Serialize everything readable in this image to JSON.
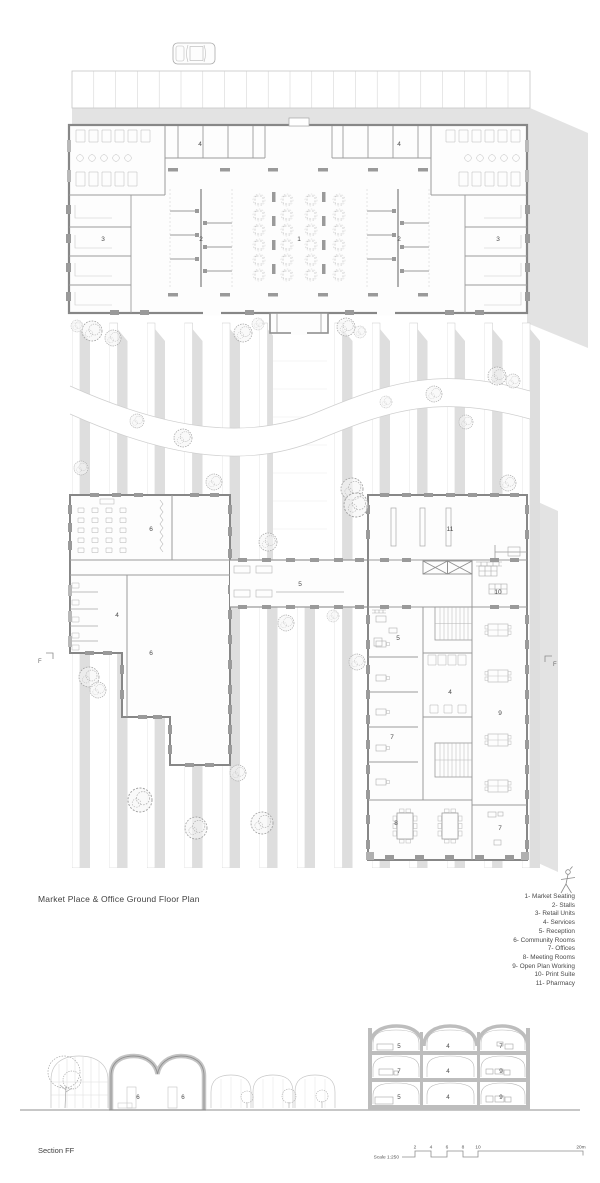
{
  "plan": {
    "title": "Market Place & Office Ground Floor Plan",
    "section_marker_left": "F",
    "section_marker_right": "F",
    "room_labels": [
      {
        "text": "4",
        "x": 200,
        "y": 146
      },
      {
        "text": "4",
        "x": 399,
        "y": 146
      },
      {
        "text": "3",
        "x": 103,
        "y": 241
      },
      {
        "text": "2",
        "x": 201,
        "y": 241
      },
      {
        "text": "1",
        "x": 299,
        "y": 241
      },
      {
        "text": "2",
        "x": 399,
        "y": 241
      },
      {
        "text": "3",
        "x": 498,
        "y": 241
      },
      {
        "text": "6",
        "x": 151,
        "y": 531
      },
      {
        "text": "11",
        "x": 450,
        "y": 531
      },
      {
        "text": "5",
        "x": 300,
        "y": 586
      },
      {
        "text": "10",
        "x": 498,
        "y": 594
      },
      {
        "text": "4",
        "x": 117,
        "y": 617
      },
      {
        "text": "5",
        "x": 398,
        "y": 640
      },
      {
        "text": "6",
        "x": 151,
        "y": 655
      },
      {
        "text": "4",
        "x": 450,
        "y": 694
      },
      {
        "text": "9",
        "x": 500,
        "y": 715
      },
      {
        "text": "7",
        "x": 392,
        "y": 739
      },
      {
        "text": "8",
        "x": 396,
        "y": 825
      },
      {
        "text": "7",
        "x": 500,
        "y": 830
      }
    ]
  },
  "legend": {
    "items": [
      "1- Market Seating",
      "2- Stalls",
      "3- Retail Units",
      "4- Services",
      "5- Reception",
      "6- Community Rooms",
      "7- Offices",
      "8- Meeting Rooms",
      "9- Open Plan Working",
      "10- Print Suite",
      "11- Pharmacy"
    ]
  },
  "section": {
    "title": "Section FF",
    "room_labels": [
      {
        "text": "6",
        "x": 138,
        "y": 1099
      },
      {
        "text": "6",
        "x": 183,
        "y": 1099
      },
      {
        "text": "5",
        "x": 399,
        "y": 1048
      },
      {
        "text": "4",
        "x": 448,
        "y": 1048
      },
      {
        "text": "7",
        "x": 501,
        "y": 1048
      },
      {
        "text": "7",
        "x": 399,
        "y": 1073
      },
      {
        "text": "4",
        "x": 448,
        "y": 1073
      },
      {
        "text": "9",
        "x": 501,
        "y": 1073
      },
      {
        "text": "5",
        "x": 399,
        "y": 1099
      },
      {
        "text": "4",
        "x": 448,
        "y": 1099
      },
      {
        "text": "9",
        "x": 501,
        "y": 1099
      }
    ]
  },
  "scale_bar": {
    "label": "Scale 1:250",
    "ticks": [
      {
        "text": "2",
        "x": 415
      },
      {
        "text": "4",
        "x": 431
      },
      {
        "text": "6",
        "x": 447
      },
      {
        "text": "8",
        "x": 463
      },
      {
        "text": "10",
        "x": 478
      },
      {
        "text": "20m",
        "x": 581
      }
    ]
  },
  "colors": {
    "wall": "#878787",
    "shadow": "#dcdcdc",
    "tree": "#a2a2a2",
    "text": "#4a4a4a"
  }
}
